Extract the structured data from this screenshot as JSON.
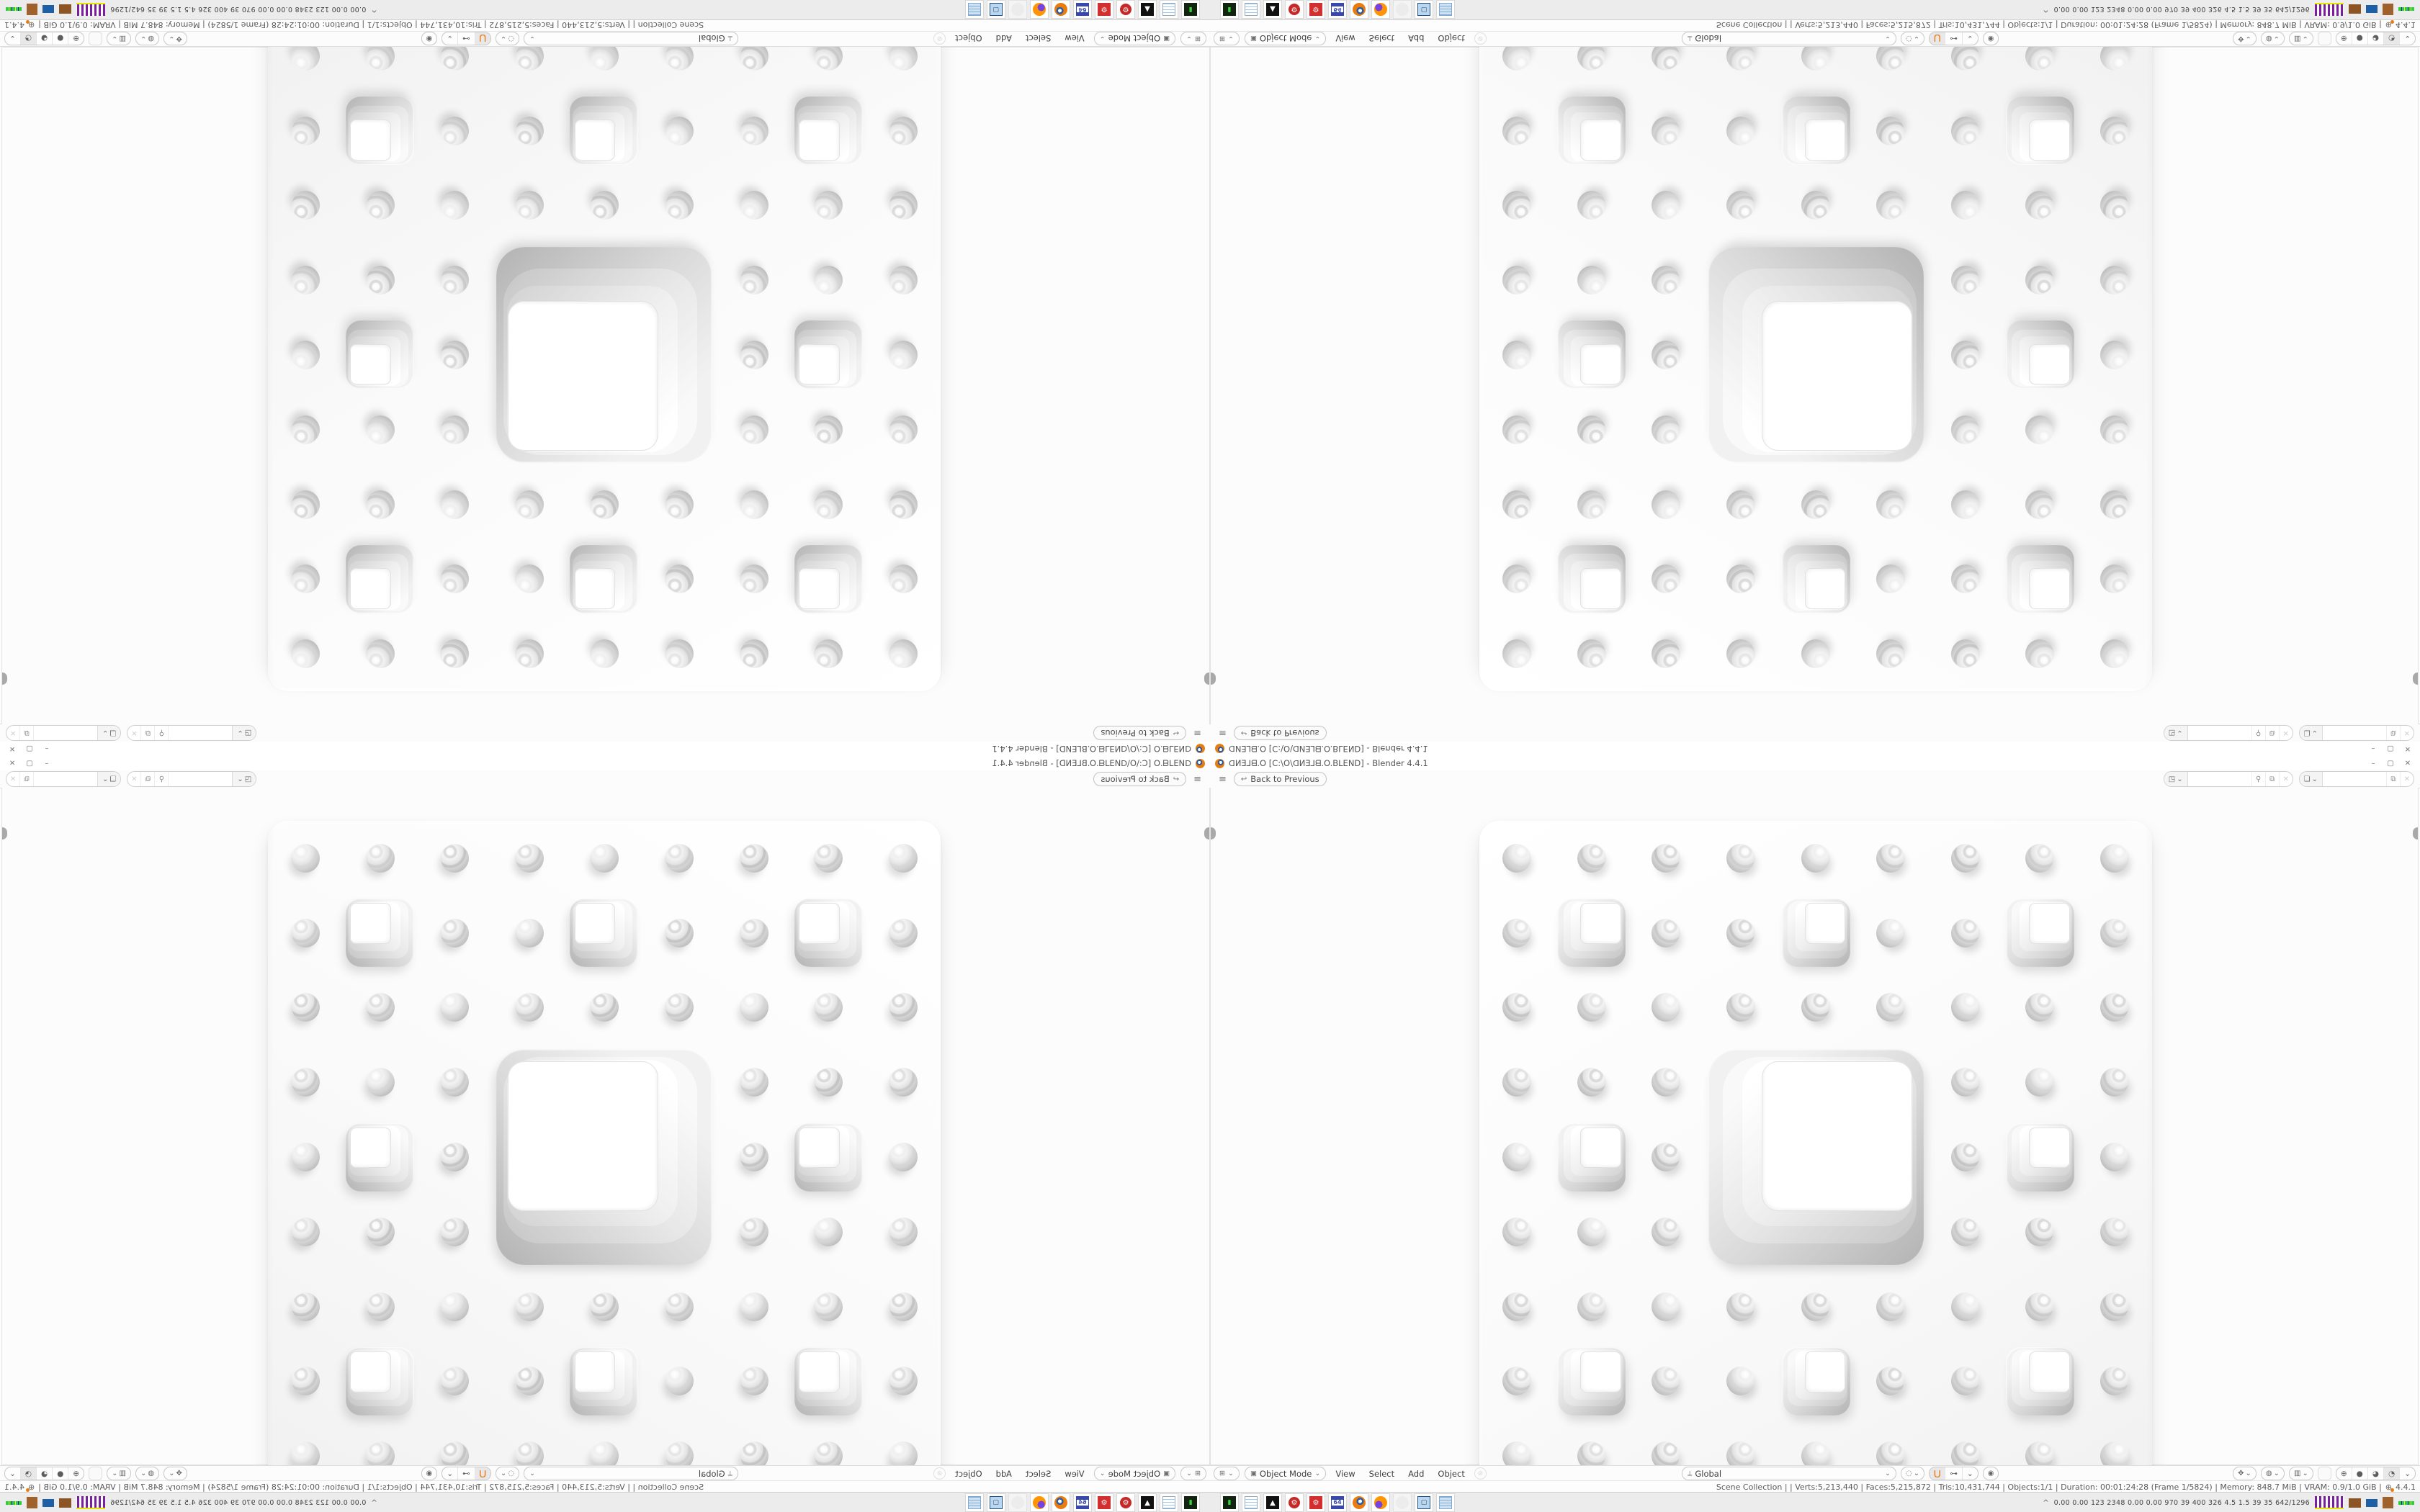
{
  "window": {
    "title": "ᗡИƎ⅃ᗺ.O [C:\\O\\ᗡИƎ⅃ᗺ.O.BLEND] - Blender 4.4.1",
    "minimize_glyph": "–",
    "restore_glyph": "▢",
    "close_glyph": "✕"
  },
  "topbar": {
    "menu_glyph": "≡",
    "back_glyph": "↩",
    "back_label": "Back to Previous",
    "scene_icon_glyph": "◳",
    "view_layer_icon_glyph": "❏",
    "pin_glyph": "⚲",
    "copy_glyph": "⧉",
    "close_glyph": "✕",
    "caret": "⌄"
  },
  "viewport": {
    "grid": 9,
    "big_hole": {
      "row": 3,
      "col": 3,
      "span": 3
    },
    "small_holes": [
      [
        1,
        1
      ],
      [
        1,
        4
      ],
      [
        1,
        7
      ],
      [
        4,
        1
      ],
      [
        4,
        7
      ],
      [
        7,
        1
      ],
      [
        7,
        4
      ],
      [
        7,
        7
      ]
    ]
  },
  "header": {
    "editor_glyph": "⊞",
    "caret": "⌄",
    "mode_glyph": "▣",
    "mode": "Object Mode",
    "menus": [
      "View",
      "Select",
      "Add",
      "Object"
    ],
    "disabled_glyph": "⊘",
    "orientation_glyph": "⟂",
    "orientation": "Global",
    "prop_glyph": "◌",
    "magnet_glyph": "⋃",
    "snap_glyph": "⊶",
    "falloff_glyph": "◉",
    "gizmo_glyph": "✥",
    "overlay_glyph": "◍",
    "xray_glyph": "▥",
    "shading_glyphs": [
      "⊕",
      "●",
      "◕",
      "◔"
    ],
    "shading_active_index": 3
  },
  "status": {
    "line": "Scene Collection  |     |  Verts:5,213,440 | Faces:5,215,872 | Tris:10,431,744 | Objects:1/1 | Duration: 00:01:24:28 (Frame 1/5824) | Memory: 848.7 MiB | VRAM: 0.9/1.0 GiB |",
    "globe_glyph": "⊕",
    "version": "4.4.1"
  },
  "taskbar": {
    "icons": [
      {
        "name": "console",
        "glyph": "▮"
      },
      {
        "name": "notepad",
        "glyph": ""
      },
      {
        "name": "inkscape",
        "glyph": "▲"
      },
      {
        "name": "gear-badge",
        "glyph": "⚙"
      },
      {
        "name": "gear-square",
        "glyph": "⚙"
      },
      {
        "name": "floppy",
        "glyph": "64"
      },
      {
        "name": "blender",
        "glyph": ""
      },
      {
        "name": "firefox",
        "glyph": ""
      },
      {
        "name": "ghost",
        "glyph": ""
      },
      {
        "name": "monitor",
        "glyph": "▢"
      },
      {
        "name": "calc",
        "glyph": ""
      }
    ],
    "tray_chevron": "^",
    "tray_text": "0.00 0.00  123 2348 0.00 0.00  970   39   400  326   4.5   1.5   39   35  642/1296"
  },
  "colors": {
    "accent_orange": "#e87d0d",
    "ui_background": "#fdfdfd",
    "taskbar_background": "#ececec",
    "spark_purple": "#7b1fa2",
    "spark_yellow": "#e6e600"
  }
}
